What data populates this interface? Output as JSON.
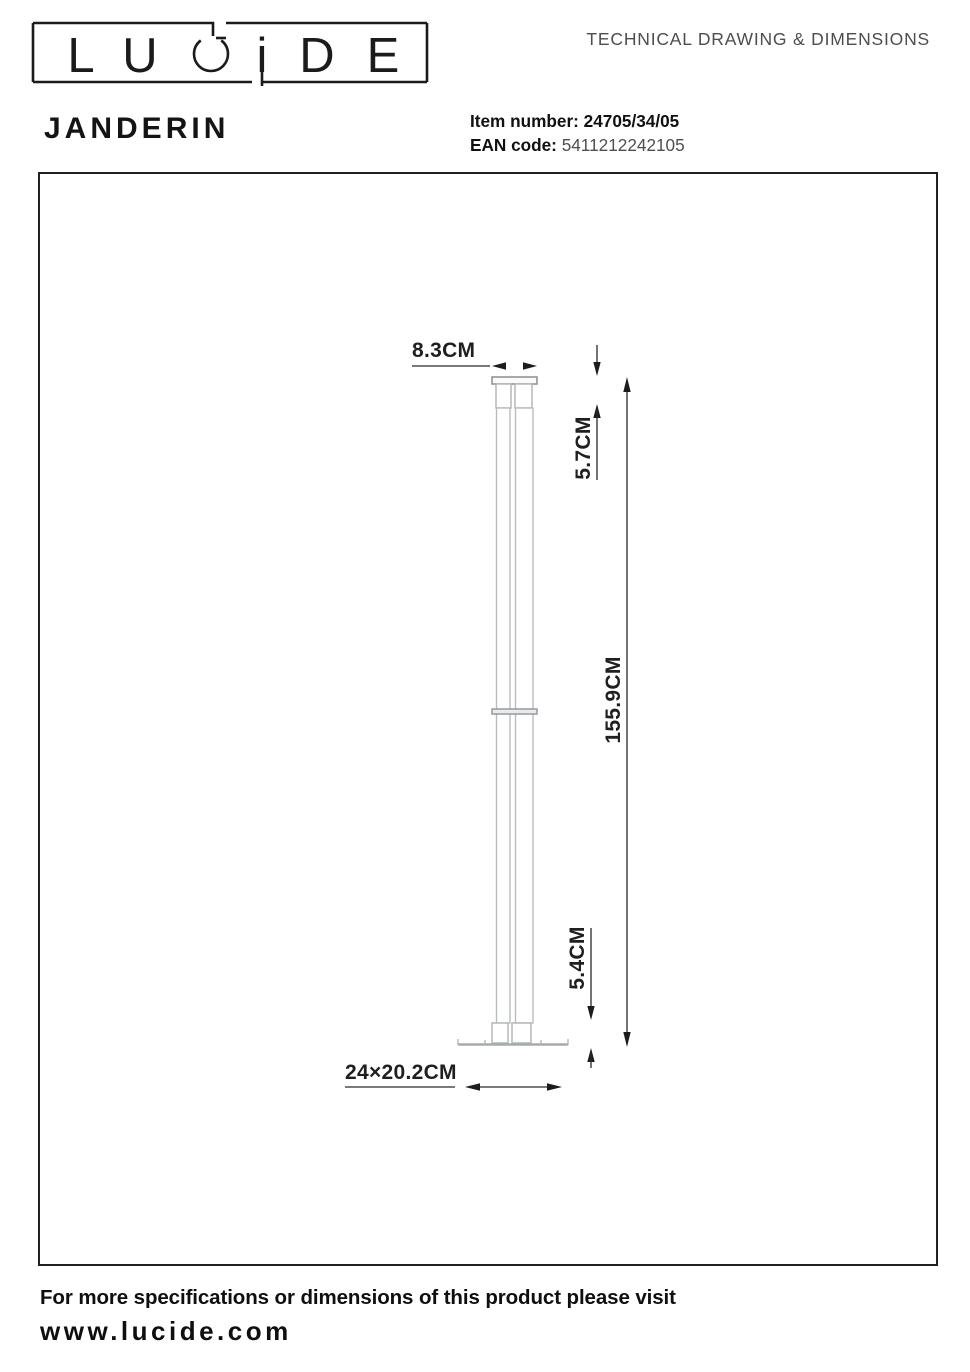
{
  "header": {
    "logo": {
      "brand": "LUCIDE",
      "letters": [
        "L",
        "U",
        "C",
        "i",
        "D",
        "E"
      ]
    },
    "doc_title": "TECHNICAL DRAWING & DIMENSIONS",
    "product_name": "JANDERIN",
    "item": {
      "label": "Item number:",
      "value": "24705/34/05"
    },
    "ean": {
      "label": "EAN code:",
      "value": "5411212242105"
    }
  },
  "drawing": {
    "dims": {
      "head_width": "8.3CM",
      "head_height": "5.7CM",
      "total_height": "155.9CM",
      "base_height": "5.4CM",
      "base_footprint": "24×20.2CM"
    }
  },
  "footer": {
    "note": "For more specifications or dimensions of this product please visit",
    "website": "www.lucide.com"
  },
  "colors": {
    "ink": "#1f1f1f",
    "muted_text": "#4d4d4d",
    "lamp_line": "#b4b8ba",
    "lamp_line_dark": "#8f959a",
    "frame": "#212121"
  }
}
